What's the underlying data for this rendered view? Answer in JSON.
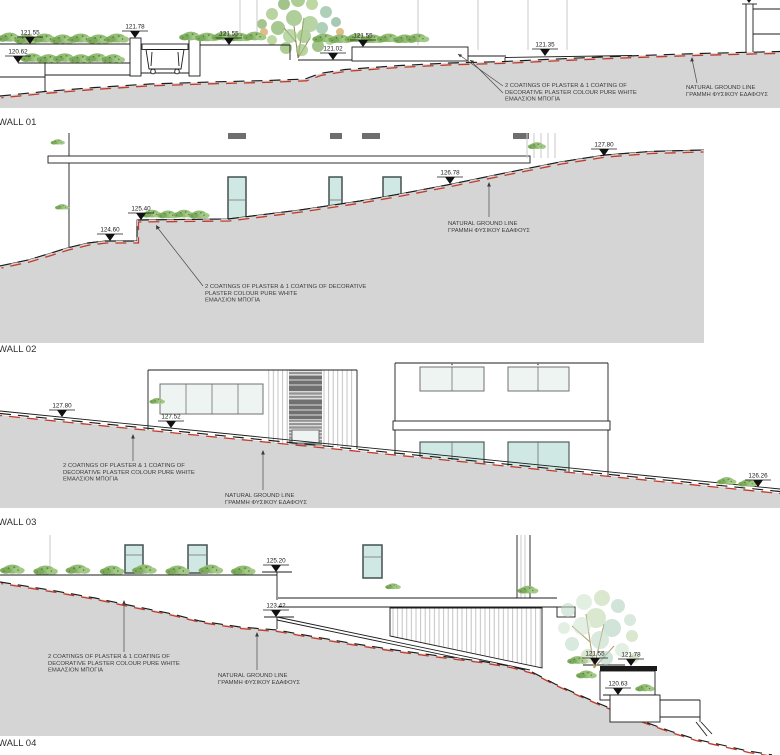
{
  "drawing": {
    "walls": [
      {
        "label": "WALL 01",
        "markers": [
          {
            "value": "121.55"
          },
          {
            "value": "120.62"
          },
          {
            "value": "121.78"
          },
          {
            "value": "121.55"
          },
          {
            "value": "121.02"
          },
          {
            "value": "121.55"
          },
          {
            "value": "121.35"
          }
        ],
        "notes": {
          "plaster": [
            "2 COATINGS OF PLASTER & 1 COATING OF",
            "DECORATIVE PLASTER COLOUR PURE WHITE",
            "ΕΜΑΛΣΙΟΝ ΜΠΟΓΙΑ"
          ],
          "ground": [
            "NATURAL GROUND LINE",
            "ΓΡΑΜΜΗ ΦΥΣΙΚΟΥ ΕΔΑΦΟΥΣ"
          ]
        }
      },
      {
        "label": "WALL 02",
        "markers": [
          {
            "value": "124.60"
          },
          {
            "value": "125.40"
          },
          {
            "value": "126.78"
          },
          {
            "value": "127.80"
          }
        ],
        "notes": {
          "plaster": [
            "2 COATINGS OF PLASTER & 1 COATING OF DECORATIVE",
            "PLASTER COLOUR PURE WHITE",
            "ΕΜΑΛΣΙΟΝ ΜΠΟΓΙΑ"
          ],
          "ground": [
            "NATURAL GROUND LINE",
            "ΓΡΑΜΜΗ ΦΥΣΙΚΟΥ ΕΔΑΦΟΥΣ"
          ]
        }
      },
      {
        "label": "WALL 03",
        "markers": [
          {
            "value": "127.80"
          },
          {
            "value": "127.52"
          },
          {
            "value": "126.26"
          }
        ],
        "notes": {
          "plaster": [
            "2 COATINGS OF PLASTER & 1 COATING OF",
            "DECORATIVE PLASTER COLOUR PURE WHITE",
            "ΕΜΑΛΣΙΟΝ ΜΠΟΓΙΑ"
          ],
          "ground": [
            "NATURAL GROUND LINE",
            "ΓΡΑΜΜΗ ΦΥΣΙΚΟΥ ΕΔΑΦΟΥΣ"
          ]
        }
      },
      {
        "label": "WALL 04",
        "markers": [
          {
            "value": "125.20"
          },
          {
            "value": "123.42"
          },
          {
            "value": "121.55"
          },
          {
            "value": "121.78"
          },
          {
            "value": "120.63"
          }
        ],
        "notes": {
          "plaster": [
            "2 COATINGS OF PLASTER & 1 COATING OF",
            "DECORATIVE PLASTER COLOUR PURE WHITE",
            "ΕΜΑΛΣΙΟΝ ΜΠΟΓΙΑ"
          ],
          "ground": [
            "NATURAL GROUND LINE",
            "ΓΡΑΜΜΗ ΦΥΣΙΚΟΥ ΕΔΑΦΟΥΣ"
          ]
        }
      }
    ],
    "colors": {
      "ground_fill": "#d5d5d5",
      "natural_ground_red": "#c23b2a",
      "line": "#1c1c1c",
      "plant_green": "#8fb872",
      "glass_teal": "#cfe8e4"
    }
  }
}
